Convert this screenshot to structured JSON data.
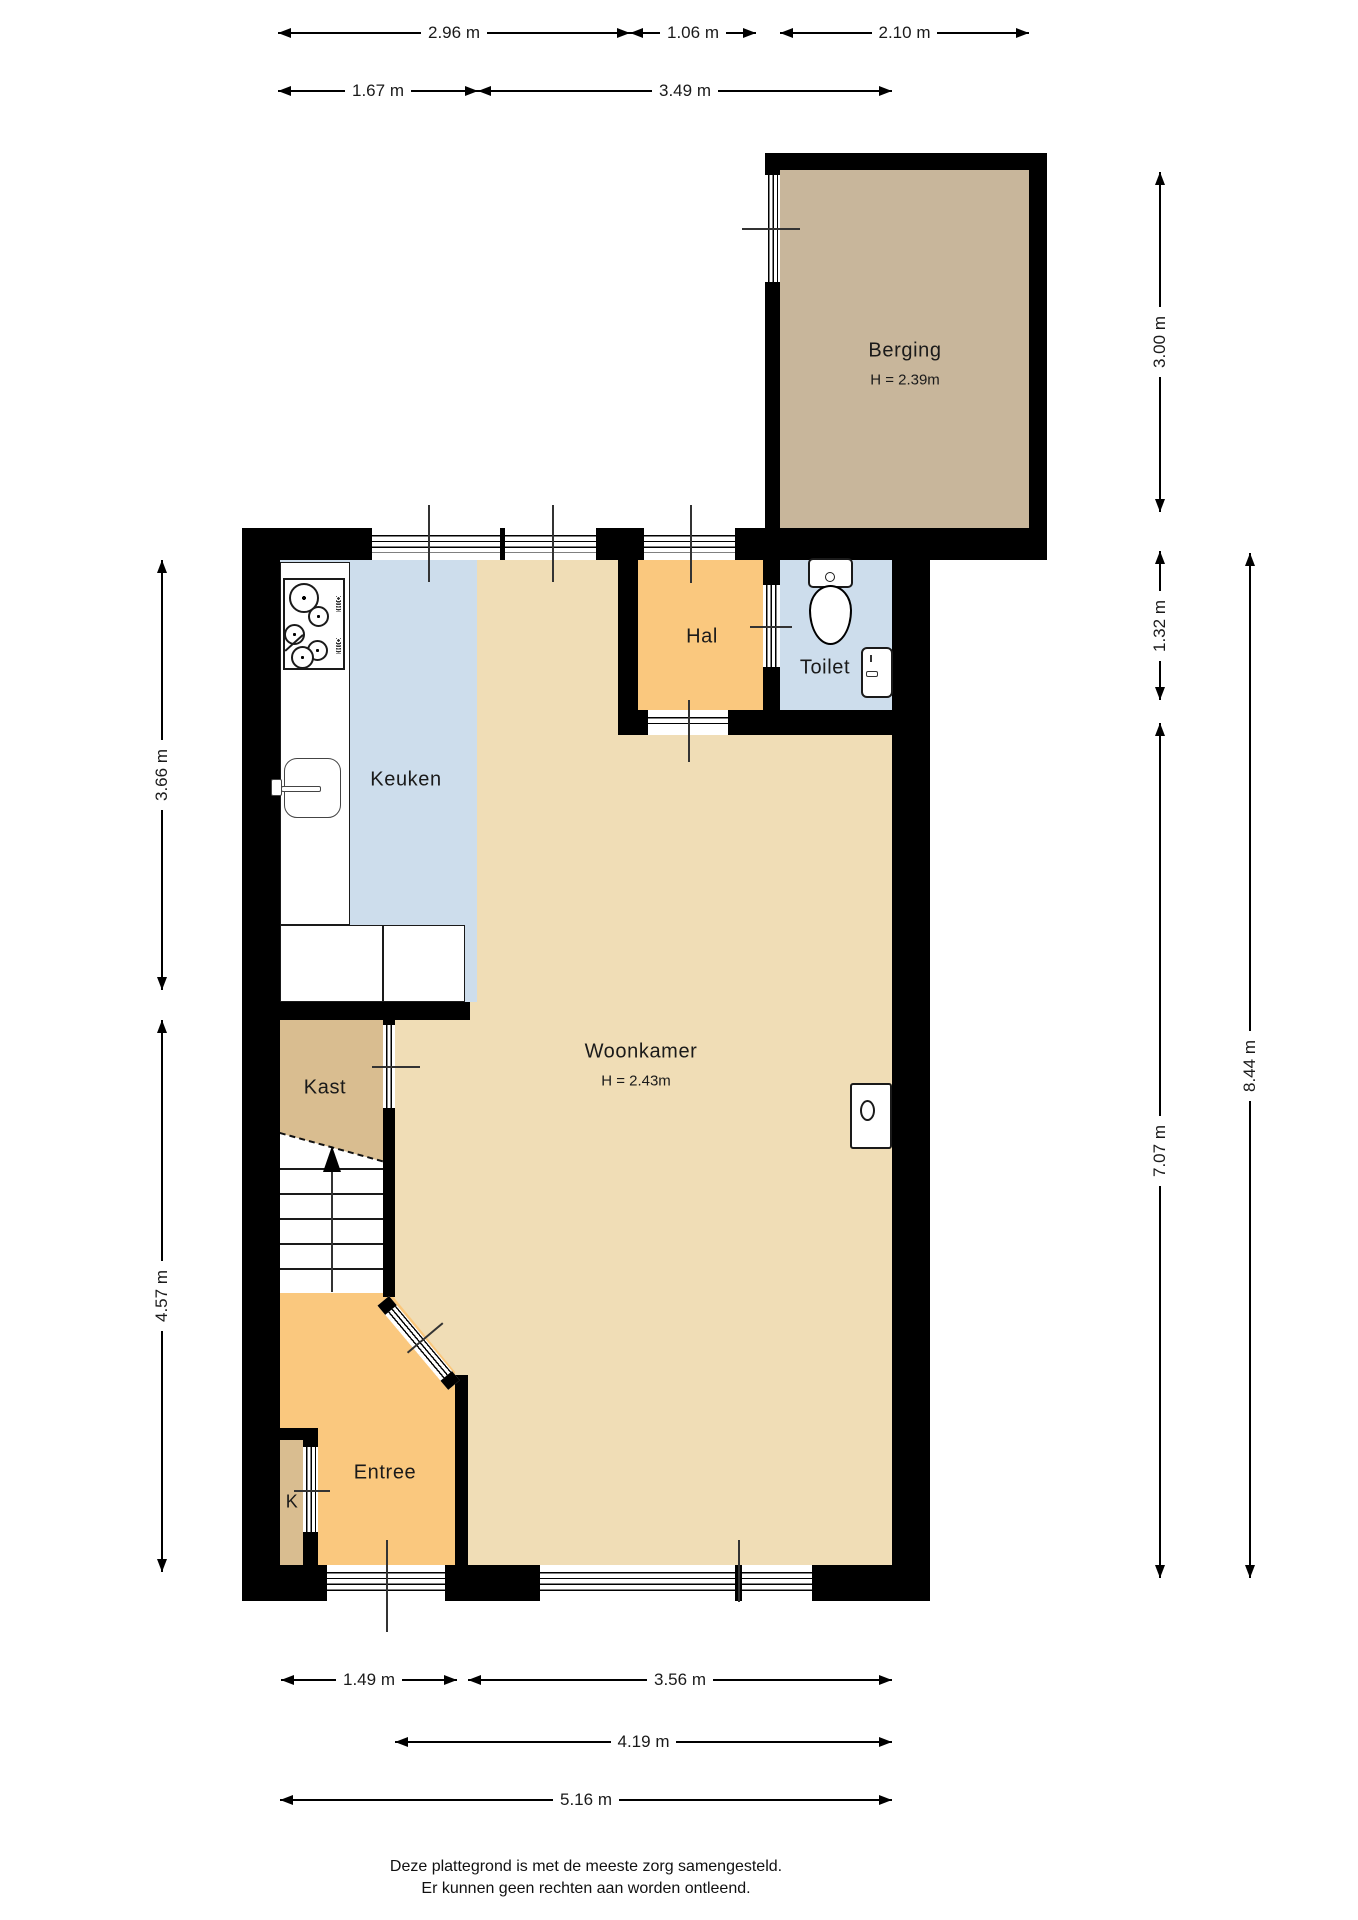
{
  "colors": {
    "wall": "#000000",
    "woonkamer_fill": "#f0ddb6",
    "blue_fill": "#cdddec",
    "orange_fill": "#fac87e",
    "kast_fill": "#d9bd90",
    "berging_fill": "#c8b69b",
    "counter_fill": "#ffffff"
  },
  "rooms": {
    "berging": {
      "label": "Berging",
      "height_note": "H = 2.39m"
    },
    "hal": {
      "label": "Hal"
    },
    "toilet": {
      "label": "Toilet"
    },
    "keuken": {
      "label": "Keuken"
    },
    "woonkamer": {
      "label": "Woonkamer",
      "height_note": "H = 2.43m"
    },
    "kast": {
      "label": "Kast"
    },
    "entree": {
      "label": "Entree"
    },
    "k_closet": {
      "label": "K"
    }
  },
  "dimensions": {
    "top_row1": [
      {
        "label": "2.96 m"
      },
      {
        "label": "1.06 m"
      },
      {
        "label": "2.10 m"
      }
    ],
    "top_row2": [
      {
        "label": "1.67 m"
      },
      {
        "label": "3.49 m"
      }
    ],
    "left": [
      {
        "label": "3.66 m"
      },
      {
        "label": "4.57 m"
      }
    ],
    "right": [
      {
        "label": "3.00 m"
      },
      {
        "label": "1.32 m"
      },
      {
        "label": "7.07 m"
      },
      {
        "label": "8.44 m"
      }
    ],
    "bottom_row1": [
      {
        "label": "1.49 m"
      },
      {
        "label": "3.56 m"
      }
    ],
    "bottom_row2": [
      {
        "label": "4.19 m"
      }
    ],
    "bottom_row3": [
      {
        "label": "5.16 m"
      }
    ]
  },
  "footer": {
    "line1": "Deze plattegrond is met de meeste zorg samengesteld.",
    "line2": "Er kunnen geen rechten aan worden ontleend."
  }
}
